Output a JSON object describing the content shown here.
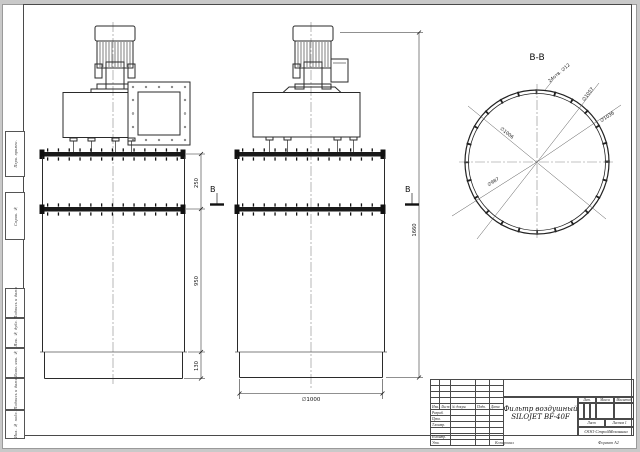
{
  "views": {
    "section_title": "B-B",
    "section_marker": "B"
  },
  "dimensions": {
    "flange_gap": "250",
    "body_mid": "950",
    "skirt": "130",
    "overall_height": "1660",
    "outer_diameter": "∅1000",
    "holes_note": "24отв. ∅12",
    "dia_1057": "∅1057",
    "dia_1036": "∅1036",
    "dia_1006": "∅1006",
    "dia_987": "∅987"
  },
  "margin_labels": [
    "Перв. примен.",
    "Справ. №",
    "Подпись и дата",
    "Инв. № дубл.",
    "Взам. инв. №",
    "Подпись и дата",
    "Инв. № подл."
  ],
  "title_block": {
    "product_name_line1": "Фильтр воздушный",
    "product_name_line2": "SILOJET BF-40F",
    "company": "ООО СтройМеханика",
    "col_izm": "Изм.",
    "col_list": "Лист",
    "col_docum": "№ докум.",
    "col_podp": "Подп.",
    "col_data": "Дата",
    "row_razrab": "Разраб.",
    "row_prov": "Пров.",
    "row_tkontr": "Т.контр.",
    "row_nkontr": "Н.контр.",
    "row_utv": "Утв.",
    "lit": "Лит.",
    "massa": "Масса",
    "masshtab": "Масштаб",
    "list_label": "Лист",
    "listov_label": "Листов  1",
    "footer_copy": "Копировал",
    "footer_format": "Формат А2"
  }
}
